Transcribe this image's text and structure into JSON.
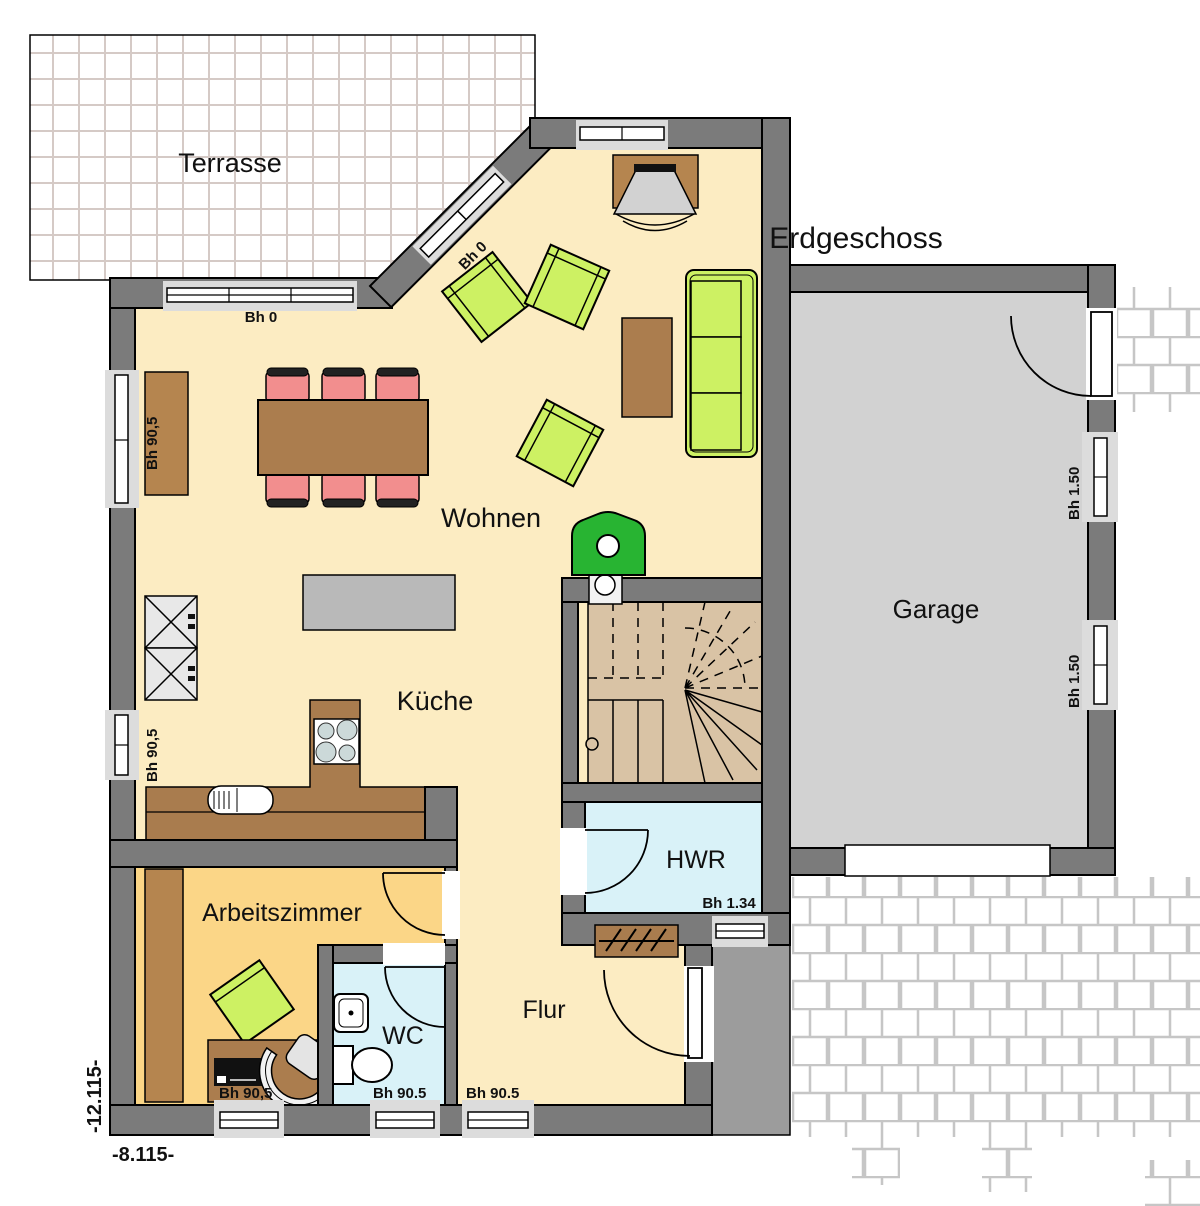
{
  "labels": {
    "title": "Erdgeschoss",
    "terrace": "Terrasse",
    "living": "Wohnen",
    "kitchen": "Küche",
    "study": "Arbeitszimmer",
    "wc": "WC",
    "hall": "Flur",
    "utility": "HWR",
    "garage": "Garage",
    "bh0_top": "Bh 0",
    "bh0_diagonal": "Bh 0",
    "bh905_living": "Bh 90,5",
    "bh905_kitchen": "Bh 90,5",
    "bh905_study": "Bh 90,5",
    "bh905_wc": "Bh 90.5",
    "bh905_hall": "Bh 90.5",
    "bh134_utility": "Bh 1.34",
    "bh150_garage_top": "Bh 1.50",
    "bh150_garage_bottom": "Bh 1.50",
    "dim_vertical": "-12.115-",
    "dim_horizontal": "-8.115-"
  },
  "colors": {
    "wall": "#7b7b7b",
    "floor_living": "#fcecc2",
    "floor_study": "#fbd687",
    "floor_wet_rooms": "#d9f2f8",
    "floor_stairs": "#d9c3a5",
    "floor_garage": "#d2d2d2",
    "porch": "#9c9c9c",
    "window_sill": "#dcdcdc",
    "furniture_wood": "#ab7d4e",
    "upholstery_green": "#cdf163",
    "chair_pink": "#f28e8e",
    "stove_green": "#28b432"
  }
}
